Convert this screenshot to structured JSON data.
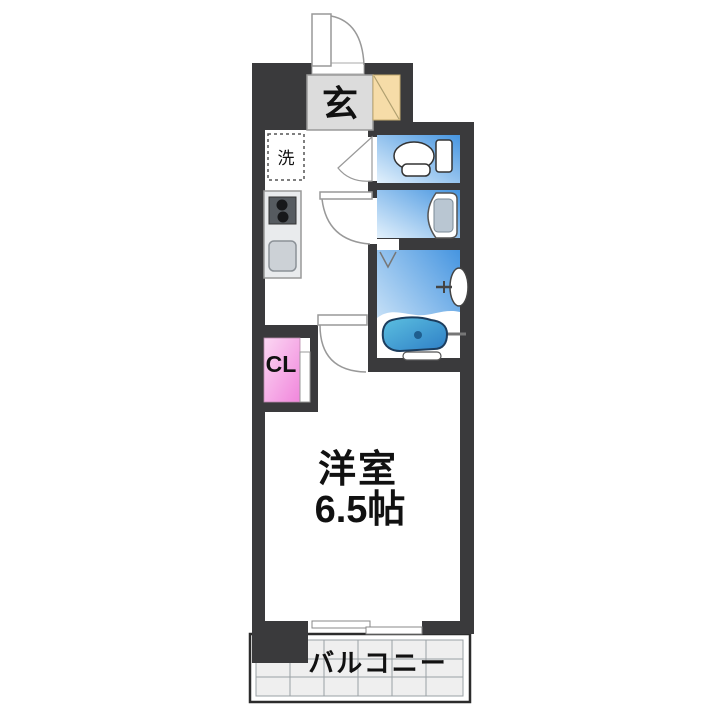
{
  "floorplan": {
    "type": "apartment-1K-floor-plan",
    "rooms": {
      "entrance": {
        "label": "玄"
      },
      "laundry_space": {
        "label": "洗"
      },
      "closet": {
        "label": "CL"
      },
      "western_room": {
        "label": "洋室",
        "size": "6.5帖"
      },
      "balcony": {
        "label": "バルコニー"
      }
    },
    "fixtures": {
      "toilet": "toilet-icon",
      "washbasin": "washbasin-icon",
      "bathtub": "bathtub-icon",
      "bath_folding_door": "folding-door-mark",
      "stove": "two-burner-stove-icon",
      "kitchen_sink": "kitchen-sink-icon",
      "shoe_cabinet": "shoe-cabinet-diagonal",
      "entry_door": "outward-swing-door",
      "interior_doors": "swing-door-arcs",
      "window": "sliding-window"
    },
    "palette": {
      "wall": "#3a3a3c",
      "water_blue_deep": "#4695e0",
      "water_blue_light": "#e3f1fc",
      "bathtub_deep": "#2e7ec6",
      "bathtub_light": "#5cc0e0",
      "closet_pink_deep": "#f186dc",
      "closet_pink_light": "#fbd7f3",
      "shoe_beige": "#f6dca8",
      "genkan_gray": "#dcdcdc",
      "balcony_tile": "#efefef",
      "text": "#111111"
    }
  }
}
